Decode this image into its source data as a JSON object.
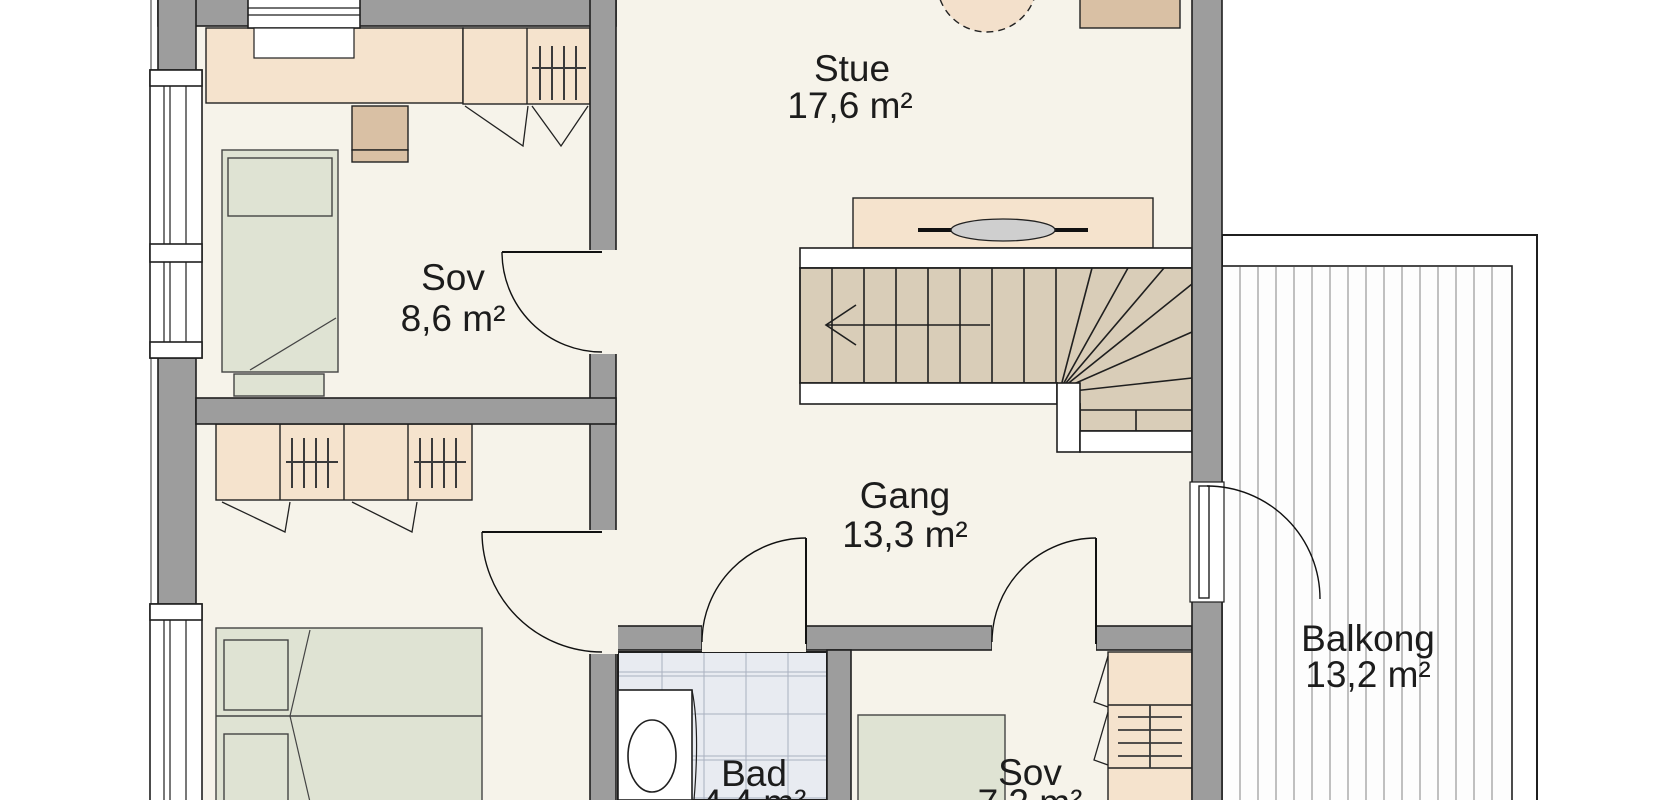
{
  "rooms": [
    {
      "id": "sov1",
      "name": "Sov",
      "area": "8,6 m²"
    },
    {
      "id": "stue",
      "name": "Stue",
      "area": "17,6 m²"
    },
    {
      "id": "gang",
      "name": "Gang",
      "area": "13,3 m²"
    },
    {
      "id": "bad",
      "name": "Bad",
      "area": "4,4 m²"
    },
    {
      "id": "sov2",
      "name": "Sov",
      "area": "7,2 m²"
    },
    {
      "id": "balkong",
      "name": "Balkong",
      "area": "13,2 m²"
    }
  ],
  "stairs": {
    "direction_arrow": "left"
  },
  "colors": {
    "floor": "#f6f3ea",
    "wall": "#9d9d9d",
    "furniture": "#f5e3cd",
    "furniture_dark": "#d9c0a4",
    "bed": "#dfe3d3",
    "stairs": "#d9cdb8",
    "bathroom_tile": "#e8ebf1",
    "balcony_deck": "#ffffff"
  }
}
